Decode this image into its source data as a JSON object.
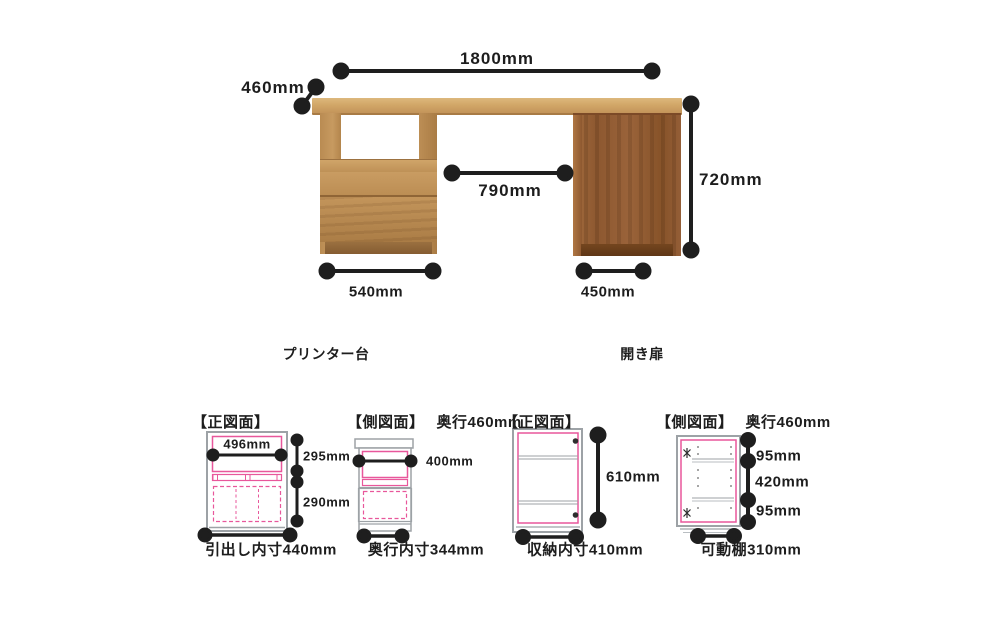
{
  "colors": {
    "dimension_line": "#1e1e1e",
    "accent_pink": "#e8579b",
    "outline_gray": "#9da2a6",
    "wood_oak": "#c79a60",
    "wood_walnut": "#91halt"
  },
  "overview": {
    "width_label": "1800mm",
    "depth_label": "460mm",
    "height_label": "720mm",
    "opening_label": "790mm",
    "left_unit_width_label": "540mm",
    "right_unit_width_label": "450mm",
    "left_unit_name": "プリンター台",
    "right_unit_name": "開き扉"
  },
  "drawings": [
    {
      "title": "【正図面】",
      "dims": {
        "inner_width": "496mm",
        "upper_height": "295mm",
        "lower_height": "290mm"
      },
      "caption": "引出し内寸440mm"
    },
    {
      "title": "【側図面】",
      "subtitle": "奥行460mm",
      "dims": {
        "inner_depth": "400mm"
      },
      "caption": "奥行内寸344mm"
    },
    {
      "title": "【正図面】",
      "dims": {
        "inner_height": "610mm"
      },
      "caption": "収納内寸410mm"
    },
    {
      "title": "【側図面】",
      "subtitle": "奥行460mm",
      "dims": {
        "shelf_top": "95mm",
        "shelf_span": "420mm",
        "shelf_bottom": "95mm"
      },
      "caption": "可動棚310mm"
    }
  ]
}
